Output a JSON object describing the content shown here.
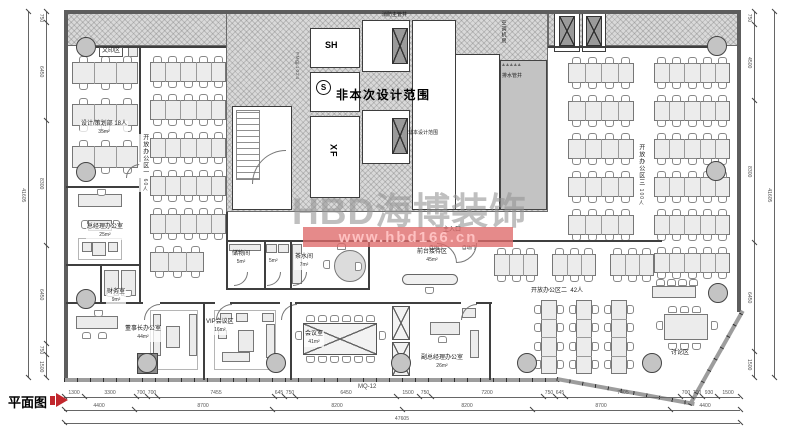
{
  "title": {
    "label": "平面图"
  },
  "watermark": {
    "brand": "HBD海博装饰",
    "url": "www.hbd166.cn"
  },
  "sheet": {
    "curtain_wall": "MQ-12"
  },
  "core": {
    "main_note": "非本次设计范围",
    "small_note": "非本设计范围",
    "scope_symbol": "S",
    "elevator_sh": "SH",
    "elevator_xf": "XF",
    "fire_shaft": "消防主管井",
    "drain_shaft": "排水管井",
    "ac_room": "空调机房",
    "door_tag": "FM甲1024",
    "zigzag": "▲▲▲▲▲"
  },
  "rooms": {
    "print": {
      "name": "文印区"
    },
    "design_dept": {
      "name": "设计/策划部 18人",
      "area": "35m²"
    },
    "open1": {
      "name": "开放办公区一",
      "count": "60人"
    },
    "gm": {
      "name": "总经理办公室",
      "area": "25m²"
    },
    "finance": {
      "name": "财务室",
      "area": "9m²"
    },
    "chairman": {
      "name": "董事长办公室",
      "area": "44m²"
    },
    "vip": {
      "name": "VIP会议区",
      "area": "16m²"
    },
    "meeting": {
      "name": "会议室",
      "area": "41m²"
    },
    "vice_gm": {
      "name": "副总经理办公室",
      "area": "26m²"
    },
    "storage": {
      "name": "储物间",
      "area": "5m²"
    },
    "wash": {
      "area": "5m²"
    },
    "tea": {
      "name": "茶水间",
      "area": "7m²"
    },
    "reception": {
      "name": "前台接待区",
      "area": "45m²"
    },
    "entrance": {
      "name": "主入口"
    },
    "auto_door": "自动门",
    "open2": {
      "name": "开放办公区二",
      "count": "42人"
    },
    "open3": {
      "name": "开放办公区三",
      "count": "100人"
    },
    "discussion": {
      "name": "讨论区"
    }
  },
  "dimensions": {
    "bottom_row1": [
      "1300",
      "3300",
      "700",
      "700",
      "7455",
      "645",
      "750",
      "6450",
      "1500",
      "750",
      "7200",
      "750",
      "645",
      "7405",
      "700",
      "700",
      "930",
      "1500"
    ],
    "bottom_row2": [
      "4400",
      "8700",
      "8200",
      "8200",
      "8700",
      "4400"
    ],
    "bottom_total": "47605",
    "left_segments": [
      "750",
      "6450",
      "8300",
      "6450",
      "750",
      "1500"
    ],
    "left_total": "41605",
    "right_segments": [
      "750",
      "4500",
      "8300",
      "6450",
      "1500"
    ],
    "right_total": "41605"
  },
  "colors": {
    "accent_red": "#c1272d",
    "watermark_red": "#de6969",
    "hatch_gray": "#d9d9d9"
  }
}
